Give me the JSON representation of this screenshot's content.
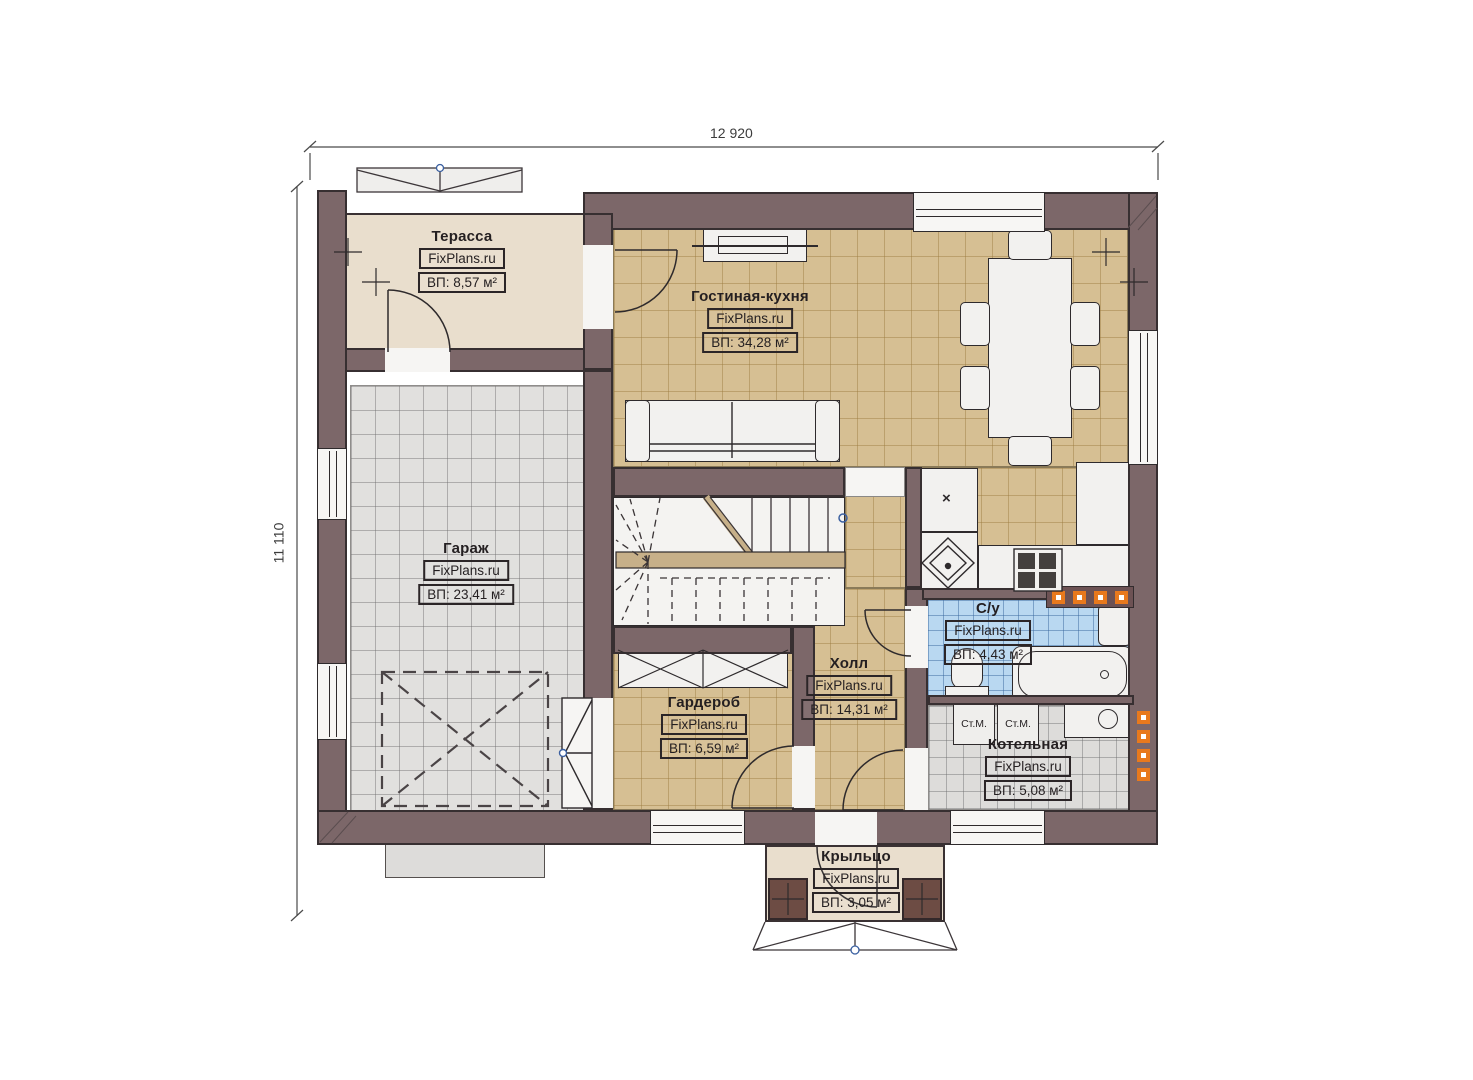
{
  "watermark": "FixPlans.ru",
  "dimensions": {
    "top": "12 920",
    "left": "11 110"
  },
  "rooms": [
    {
      "id": "terrace",
      "name": "Терасса",
      "area": "ВП: 8,57 м²"
    },
    {
      "id": "living-kitchen",
      "name": "Гостиная-кухня",
      "area": "ВП: 34,28 м²"
    },
    {
      "id": "garage",
      "name": "Гараж",
      "area": "ВП: 23,41 м²"
    },
    {
      "id": "hall",
      "name": "Холл",
      "area": "ВП: 14,31 м²"
    },
    {
      "id": "wardrobe",
      "name": "Гардероб",
      "area": "ВП: 6,59 м²"
    },
    {
      "id": "bathroom",
      "name": "С/у",
      "area": "ВП: 4,43 м²"
    },
    {
      "id": "boiler",
      "name": "Котельная",
      "area": "ВП: 5,08 м²"
    },
    {
      "id": "porch",
      "name": "Крыльцо",
      "area": "ВП: 3,05 м²"
    }
  ],
  "appliances": {
    "washer1": "Ст.М.",
    "washer2": "Ст.М.",
    "fridge_mark": "×"
  },
  "colors": {
    "wall": "#7c6769",
    "floor_tan": "#d6bf93",
    "floor_gray": "#e1e0de",
    "floor_blue": "#b9d8f1",
    "floor_terrace": "#e9decd",
    "radiator_accent": "#e8791d"
  }
}
